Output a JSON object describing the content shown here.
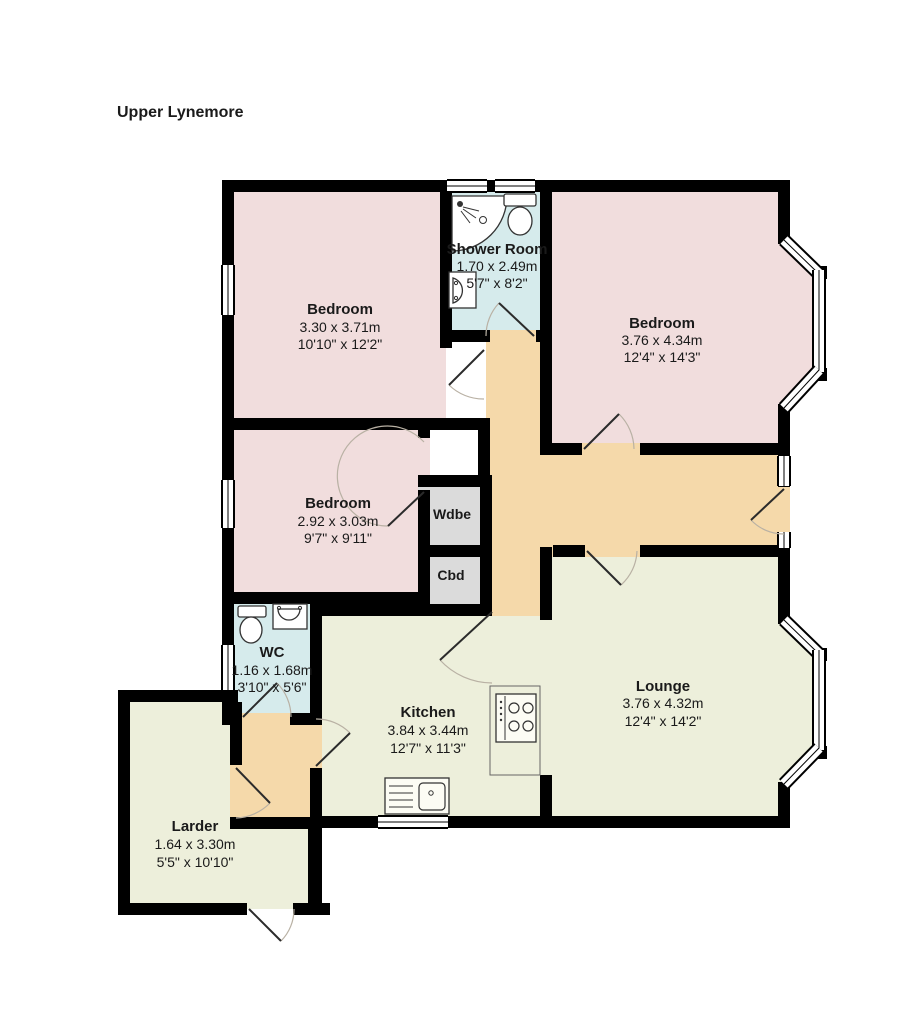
{
  "title": "Upper Lynemore",
  "colors": {
    "bedroom": "#f1dddd",
    "bathroom": "#d6ebec",
    "hallway": "#f5d9aa",
    "living": "#edefdb",
    "closet": "#dbdbdb",
    "wall": "#000000"
  },
  "rooms": [
    {
      "name": "Bedroom",
      "dim_m": "3.30 x 3.71m",
      "dim_ft": "10'10\" x 12'2\""
    },
    {
      "name": "Shower Room",
      "dim_m": "1.70 x 2.49m",
      "dim_ft": "5'7\" x 8'2\""
    },
    {
      "name": "Bedroom",
      "dim_m": "3.76 x 4.34m",
      "dim_ft": "12'4\" x 14'3\""
    },
    {
      "name": "Bedroom",
      "dim_m": "2.92 x 3.03m",
      "dim_ft": "9'7\" x 9'11\""
    },
    {
      "name": "WC",
      "dim_m": "1.16 x 1.68m",
      "dim_ft": "3'10\" x 5'6\""
    },
    {
      "name": "Kitchen",
      "dim_m": "3.84 x 3.44m",
      "dim_ft": "12'7\" x 11'3\""
    },
    {
      "name": "Lounge",
      "dim_m": "3.76 x 4.32m",
      "dim_ft": "12'4\" x 14'2\""
    },
    {
      "name": "Larder",
      "dim_m": "1.64 x 3.30m",
      "dim_ft": "5'5\" x 10'10\""
    }
  ],
  "closets": {
    "wardrobe": "Wdbe",
    "cupboard": "Cbd"
  }
}
